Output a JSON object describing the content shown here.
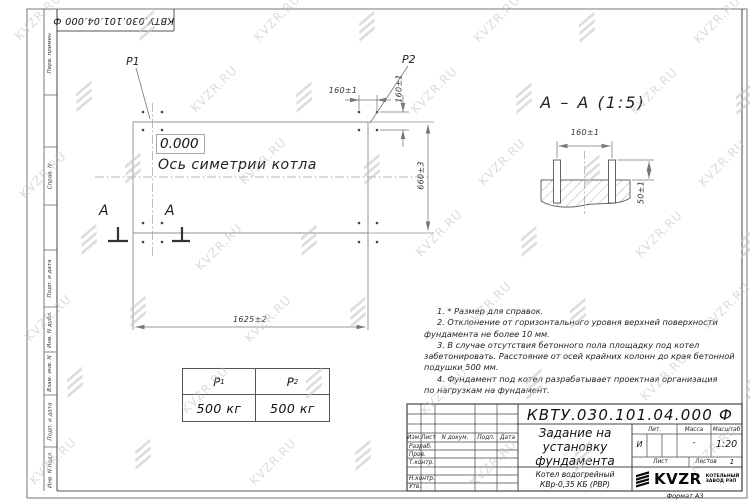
{
  "sheet": {
    "doc_number_top": "КВТУ.030.101.04.000 Ф",
    "format_label": "Формат А3"
  },
  "watermark": {
    "text": "KVZR.RU"
  },
  "margin_strips": {
    "items": [
      "Перв. примен.",
      "Справ. N",
      "Подп. и дата",
      "Инв. N дубл.",
      "Взам. инв. N",
      "Подп. и дата",
      "Инв. N подл."
    ]
  },
  "plan": {
    "p1_label": "P1",
    "p2_label": "P2",
    "level_mark": "0.000",
    "axis_label": "Ось симетрии котла",
    "dim_width": "1625±2",
    "dim_height": "660±3",
    "dim_bolt_h": "160±1",
    "dim_bolt_v": "160±1",
    "section_letter_left": "А",
    "section_letter_right": "А"
  },
  "section_view": {
    "title": "А – А (1:5)",
    "dim_spacing": "160±1",
    "dim_height": "50±1"
  },
  "notes": {
    "lines": [
      "1. * Размер для справок.",
      "2. Отклонение от горизонтального уровня верхней поверхности",
      "фундамента не более 10 мм.",
      "3. В случае отсутствия бетонного пола площадку под котел",
      "забетонировать. Расстояние от осей крайних колонн до края бетонной",
      "подушки 500 мм.",
      "4. Фундамент под котел разрабатывает проектная организация",
      "по нагрузкам на фундамент."
    ]
  },
  "load_table": {
    "headers": [
      {
        "main": "P",
        "sub": "1"
      },
      {
        "main": "P",
        "sub": "2"
      }
    ],
    "values": [
      "500 кг",
      "500 кг"
    ]
  },
  "title_block": {
    "doc_number": "КВТУ.030.101.04.000  Ф",
    "title_lines": [
      "Задание на",
      "установку",
      "фундамента"
    ],
    "product_lines": [
      "Котел водогрейный",
      "КВр-0,35 КБ (РВР)"
    ],
    "header_cols": [
      "Изм.",
      "Лист",
      "N докум.",
      "Подп.",
      "Дата"
    ],
    "row_labels": [
      "Разраб.",
      "Пров.",
      "Т.контр.",
      "",
      "Н.контр.",
      "Утв."
    ],
    "lit_label": "Лит.",
    "mass_label": "Масса",
    "scale_label": "Масштаб",
    "lit_value": "И",
    "mass_value": "-",
    "scale_value": "1:20",
    "sheet_label": "Лист",
    "sheets_label": "Листов",
    "sheets_value": "1",
    "company": {
      "name": "KVZR",
      "sub1": "КОТЕЛЬНЫЙ",
      "sub2": "ЗАВОД РЭП"
    }
  }
}
